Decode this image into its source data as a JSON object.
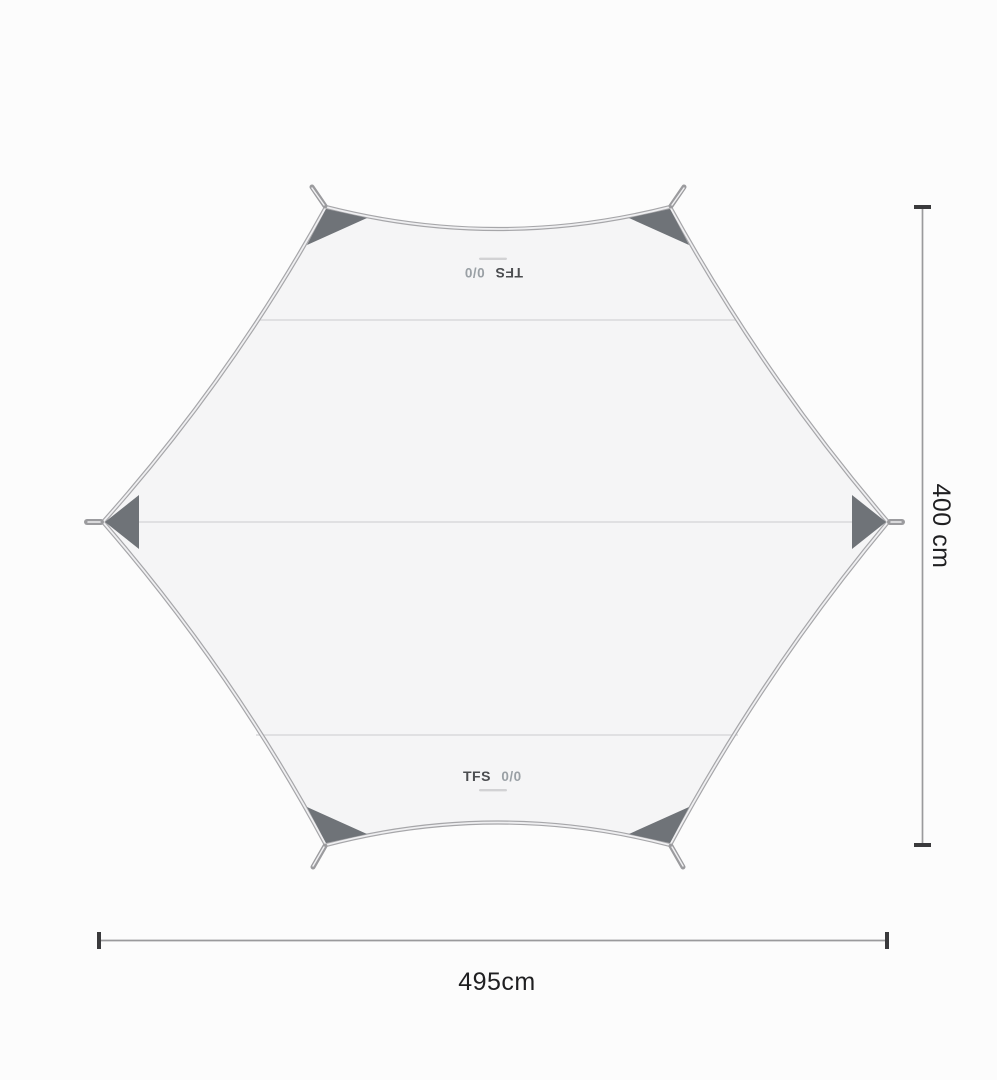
{
  "page": {
    "background": "#fcfcfc"
  },
  "tarp": {
    "shape": "hexagonal tarp, catenary-cut edges, six reinforced corners",
    "brand": "TFS",
    "model": "0/0",
    "colors": {
      "fabric": "#f5f5f6",
      "outline": "#a6a6a9",
      "hem_inner": "#efeff1",
      "seam": "#dadadc",
      "patch": "#6f7378",
      "loop": "#9b9b9e",
      "brand_text": "#4b4d50",
      "model_text": "#9aa0a5",
      "tagline_mark": "#c9c9cc"
    }
  },
  "dimensions": {
    "height": {
      "label": "400 cm"
    },
    "width": {
      "label": "495cm"
    },
    "line_color": "#9a9a9c",
    "cap_color": "#3a3a3c",
    "text_color": "#1f1f21"
  }
}
